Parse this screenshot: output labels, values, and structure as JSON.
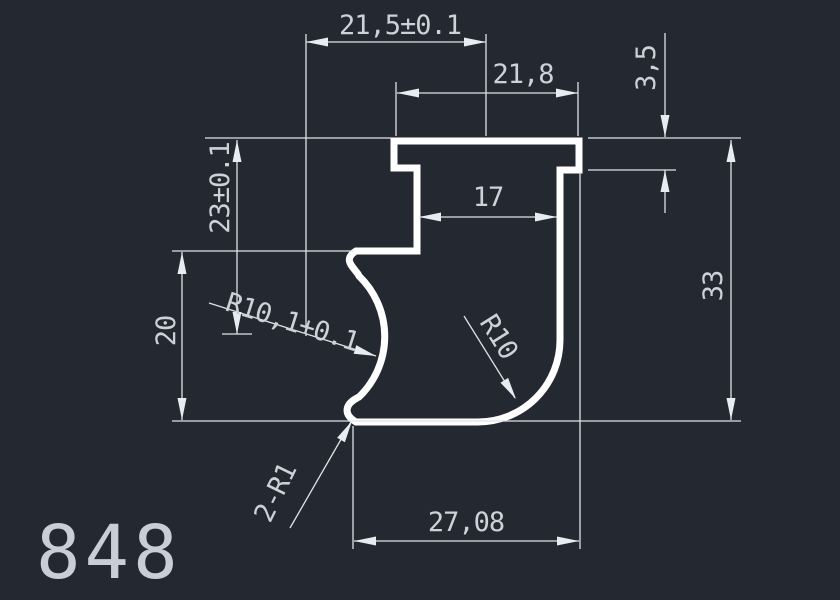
{
  "drawing": {
    "part_number": "848",
    "colors": {
      "background": "#242931",
      "profile_stroke": "#ffffff",
      "dimension_lines": "#dfe2e7",
      "dimension_text": "#cdd2d9"
    },
    "dimensions": {
      "top_width_toleranced": "21,5±0.1",
      "cap_width": "21,8",
      "flange_thickness": "3,5",
      "inner_opening_width": "17",
      "total_height": "33",
      "left_height_toleranced": "23±0.1",
      "bulge_height": "20",
      "left_concave_radius": "R10,1+0.1",
      "bottom_corner_radius": "R10",
      "notch_radii": "2-R1",
      "bottom_width": "27,08"
    }
  }
}
